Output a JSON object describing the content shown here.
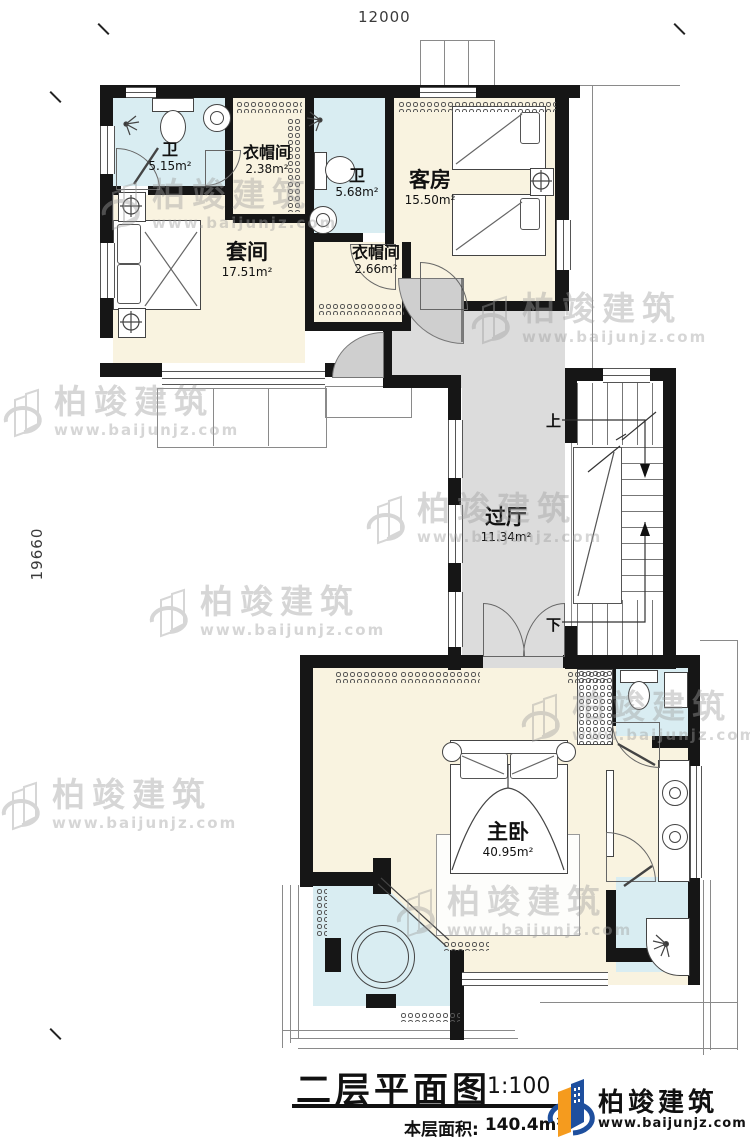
{
  "dimensions": {
    "top": "12000",
    "left": "19660"
  },
  "rooms": {
    "bath1": {
      "name": "卫",
      "area": "5.15m²"
    },
    "closet1": {
      "name": "衣帽间",
      "area": "2.38m²"
    },
    "bath2": {
      "name": "卫",
      "area": "5.68m²"
    },
    "guest": {
      "name": "客房",
      "area": "15.50m²"
    },
    "suite": {
      "name": "套间",
      "area": "17.51m²"
    },
    "closet2": {
      "name": "衣帽间",
      "area": "2.66m²"
    },
    "hall": {
      "name": "过厅",
      "area": "11.34m²"
    },
    "master": {
      "name": "主卧",
      "area": "40.95m²"
    }
  },
  "stairs": {
    "up": "上",
    "down": "下"
  },
  "title": {
    "text": "二层平面图",
    "scale": "1:100",
    "area_label": "本层面积:",
    "area_value": "140.4m²"
  },
  "brand": {
    "name": "柏竣建筑",
    "url": "www.baijunjz.com"
  },
  "watermark": {
    "name": "柏竣建筑",
    "url": "www.baijunjz.com"
  },
  "colors": {
    "wall": "#161616",
    "room_cream": "#f9f3e0",
    "room_bath": "#d9edf2",
    "hall_gray": "#dcdcdc",
    "brand_blue": "#1e4f9e",
    "brand_orange": "#f59b1e"
  }
}
